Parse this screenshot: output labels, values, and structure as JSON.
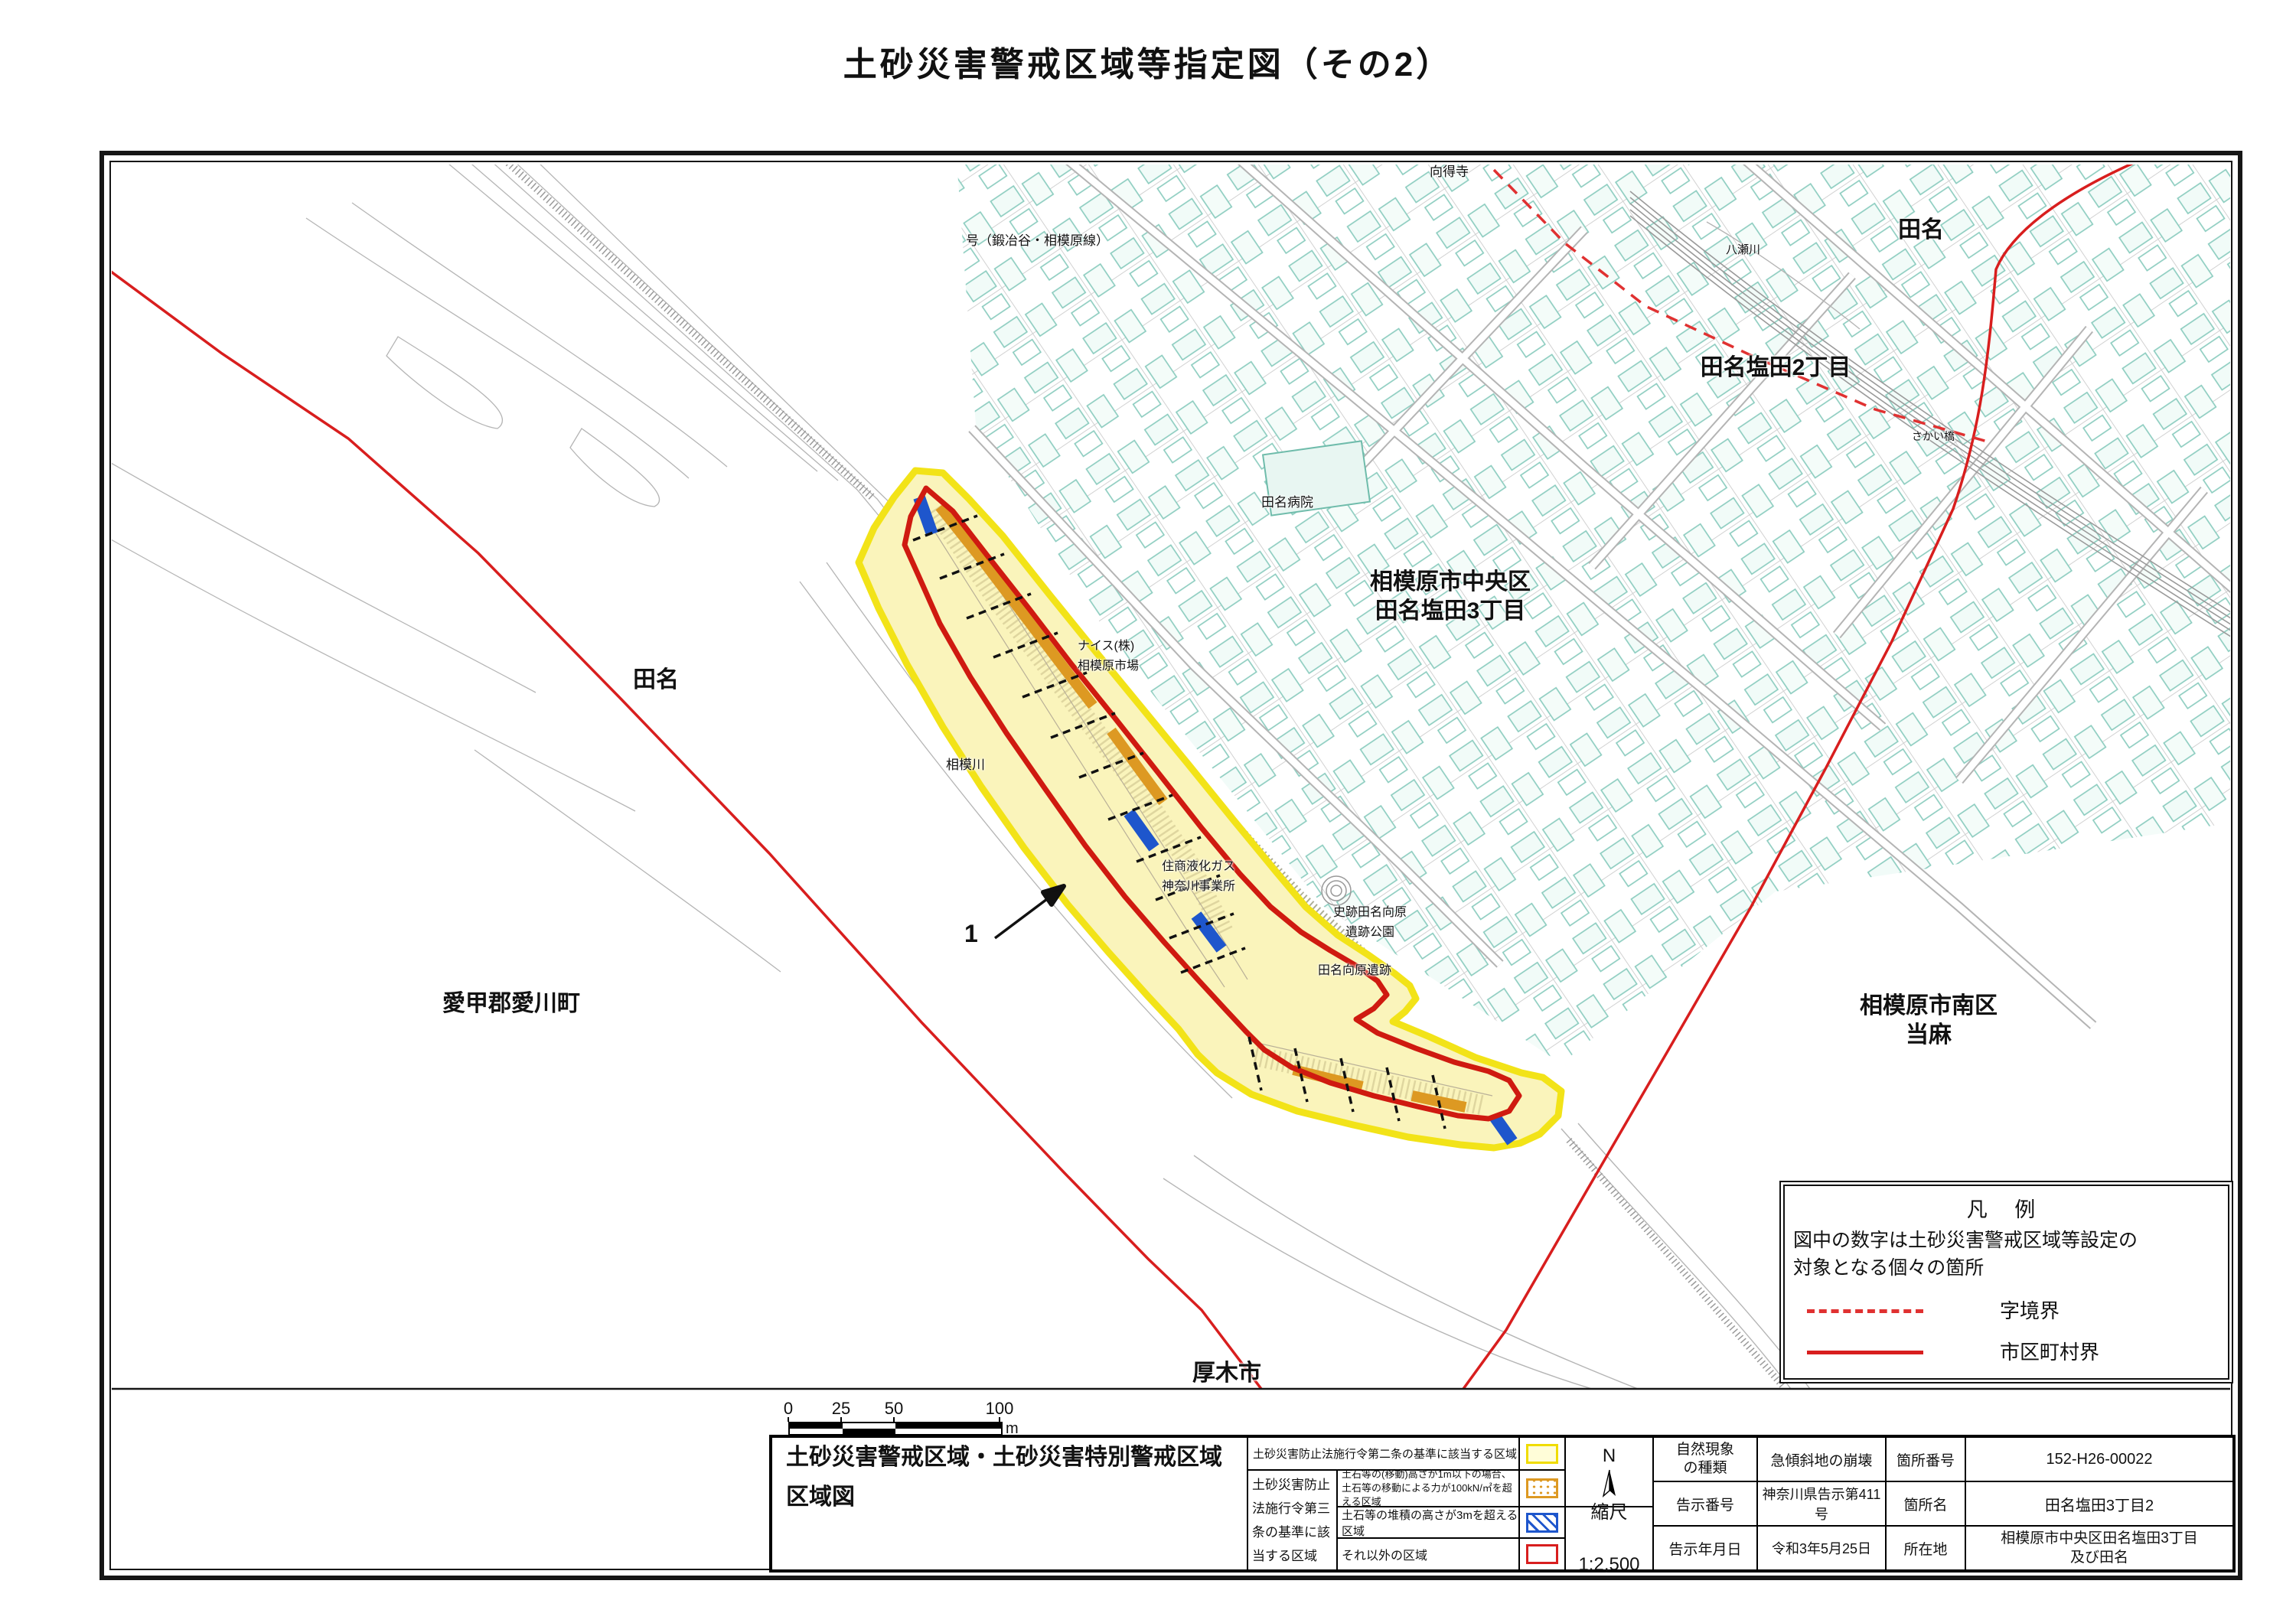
{
  "title": "土砂災害警戒区域等指定図（その2）",
  "map_labels": {
    "mukutokuji": "向得寺",
    "route_name": "号（鍛冶谷・相模原線）",
    "yasegawa": "八瀬川",
    "tana_ne": "田名",
    "tana_shioda_2": "田名塩田2丁目",
    "sakai_bashi": "さかい橋",
    "chuo_ward": "相模原市中央区\n田名塩田3丁目",
    "tana_hospital": "田名病院",
    "nice_market": "ナイス(株)\n相模原市場",
    "sagami_river": "相模川",
    "sumisho_gas": "住商液化ガス\n神奈川事業所",
    "shiseki_park": "史跡田名向原\n遺跡公園",
    "iseki": "田名向原遺跡",
    "tana_west": "田名",
    "aikawa_town": "愛甲郡愛川町",
    "minami_ward": "相模原市南区\n当麻",
    "atsugi_city": "厚木市",
    "spot_number": "1"
  },
  "legend": {
    "title": "凡 例",
    "note": "図中の数字は土砂災害警戒区域等設定の\n対象となる個々の箇所",
    "items": [
      {
        "label": "字境界",
        "line_style": "red-dashed"
      },
      {
        "label": "市区町村界",
        "line_style": "red-solid"
      }
    ]
  },
  "scale_bar": {
    "ticks": [
      "0",
      "25",
      "50",
      "100"
    ],
    "unit": "m"
  },
  "zone_colors": {
    "warning_zone_yellow": "#f2e318",
    "special_move_orange": "#dd9922",
    "special_deposit_blue": "#1e56cc",
    "special_other_red": "#d81e1e"
  },
  "info_table": {
    "sheet_title": "土砂災害警戒区域・土砂災害特別警戒区域\n区域図",
    "article2_label": "土砂災害防止法施行令第二条の基準に該当する区域",
    "article3_label": "土砂災害防止法施行令第三条の基準に該当する区域",
    "article3_rows": {
      "move": "土石等の(移動)高さが1m以下の場合、\n土石等の移動による力が100kN/㎡を超える区域",
      "deposit": "土石等の堆積の高さが3mを超える区域",
      "other": "それ以外の区域"
    },
    "north_label": "N",
    "scale_label": "縮尺",
    "scale_value": "1:2,500",
    "rows": [
      {
        "label1": "自然現象\nの種類",
        "value1": "急傾斜地の崩壊",
        "label2": "箇所番号",
        "value2": "152-H26-00022"
      },
      {
        "label1": "告示番号",
        "value1": "神奈川県告示第411号",
        "label2": "箇所名",
        "value2": "田名塩田3丁目2"
      },
      {
        "label1": "告示年月日",
        "value1": "令和3年5月25日",
        "label2": "所在地",
        "value2": "相模原市中央区田名塩田3丁目\n及び田名"
      }
    ]
  }
}
